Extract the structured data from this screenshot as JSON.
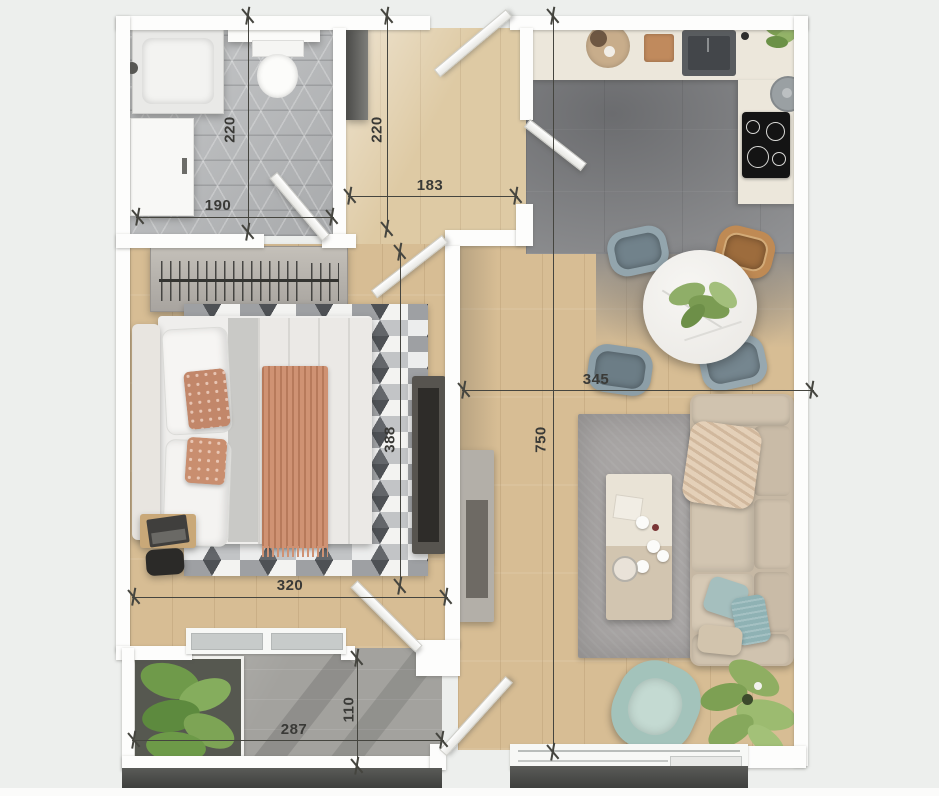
{
  "canvas": {
    "width": 939,
    "height": 796
  },
  "palette": {
    "background": "#edefed",
    "wall": "#fdfdfc",
    "wood_floor": "#d7bd94",
    "hall_wood": "#decaa4",
    "bathroom_tile": "#b6b8ba",
    "kitchen_tile": "#97989a",
    "balcony_tile": "#a3a29e",
    "counter_cream": "#ece7db",
    "sofa_beige": "#c6b8a4",
    "rug_living_gray": "#a8a5a4",
    "chair_gray_blue": "#8c9ea7",
    "chair_wicker": "#bf8a54",
    "accent_terracotta": "#c2876a",
    "accent_mint": "#a3c3bb",
    "plant_green": "#7da053",
    "dimension_ink": "#3a3a37",
    "dark_band": "#3e3f3d",
    "cooktop_black": "#141414"
  },
  "dimensions": [
    {
      "id": "bathroom-height",
      "label": "220",
      "orientation": "vertical"
    },
    {
      "id": "bathroom-width",
      "label": "190",
      "orientation": "horizontal"
    },
    {
      "id": "hallway-height",
      "label": "220",
      "orientation": "vertical"
    },
    {
      "id": "hallway-width",
      "label": "183",
      "orientation": "horizontal"
    },
    {
      "id": "living-width",
      "label": "345",
      "orientation": "horizontal"
    },
    {
      "id": "bedroom-height",
      "label": "388",
      "orientation": "vertical"
    },
    {
      "id": "apartment-depth",
      "label": "750",
      "orientation": "vertical"
    },
    {
      "id": "bedroom-width",
      "label": "320",
      "orientation": "horizontal"
    },
    {
      "id": "balcony-depth",
      "label": "110",
      "orientation": "vertical"
    },
    {
      "id": "balcony-width",
      "label": "287",
      "orientation": "horizontal"
    }
  ]
}
